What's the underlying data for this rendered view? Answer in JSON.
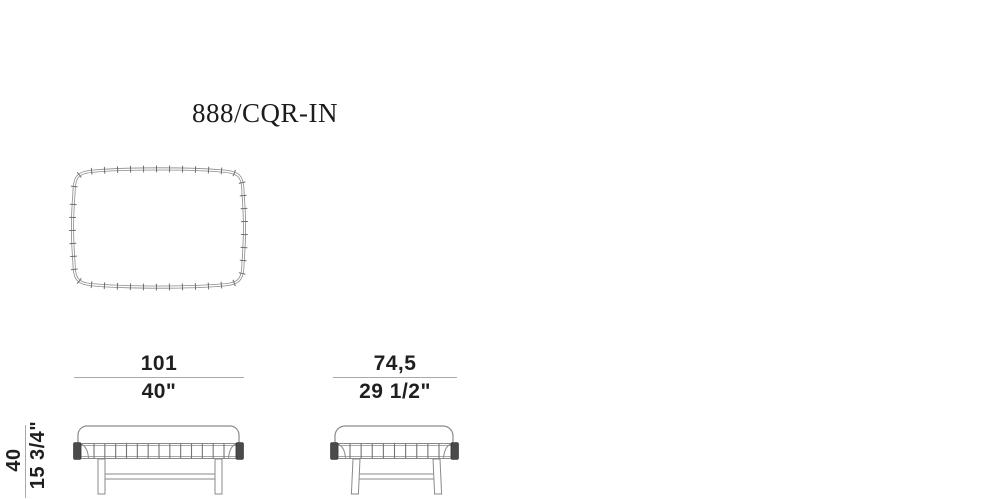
{
  "title": "888/CQR-IN",
  "dimensions": {
    "width_front": {
      "metric": "101",
      "imperial": "40\""
    },
    "depth_side": {
      "metric": "74,5",
      "imperial": "29 1/2\""
    },
    "height": {
      "metric": "40",
      "imperial": "15 3/4\""
    }
  },
  "colors": {
    "drawing_line": "#8a8a8a",
    "stitch_tick": "#6f6f6f",
    "dimension_line": "#a9a9a9",
    "text": "#1f1f1f",
    "end_cap": "#4a4a4a",
    "background": "#ffffff"
  }
}
